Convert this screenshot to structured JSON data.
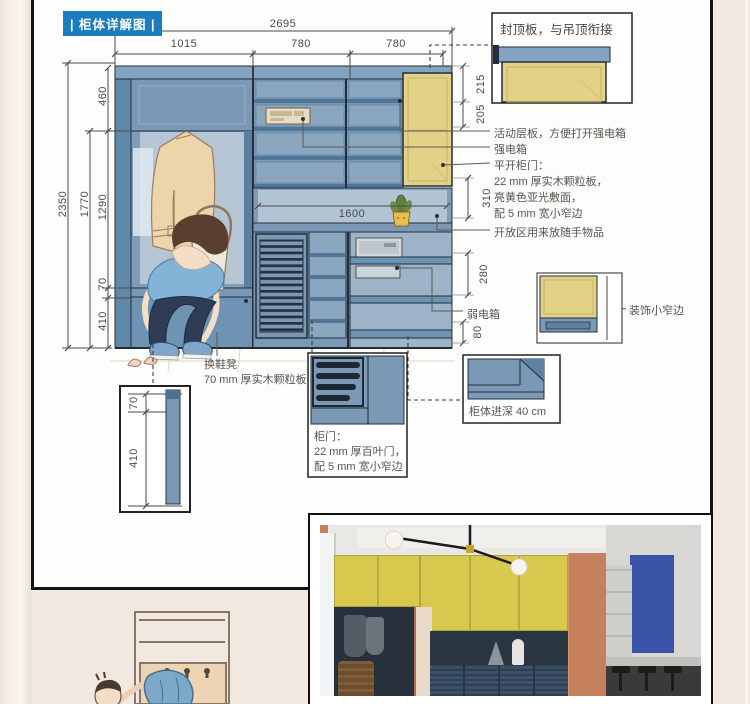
{
  "title": "| 柜体详解图 |",
  "dims": {
    "total_width": "2695",
    "col1": "1015",
    "col2": "780",
    "col3": "780",
    "total_height": "2350",
    "top_cab": "460",
    "open_total": "1770",
    "open_h": "1290",
    "bench_top": "70",
    "bench_h": "410",
    "r215": "215",
    "r205": "205",
    "r310": "310",
    "r280": "280",
    "r80": "80",
    "shelf_width": "1600",
    "bench_d70": "70",
    "bench_d410": "410"
  },
  "notes": {
    "cap_board": "封顶板，与吊顶衔接",
    "movable_shelf": "活动层板，方便打开强电箱",
    "strong_box": "强电箱",
    "swing1": "平开柜门：",
    "swing2": "22 mm 厚实木颗粒板，",
    "swing3": "亮黄色亚光敷面，",
    "swing4": "配 5 mm 宽小窄边",
    "open_area": "开放区用来放随手物品",
    "weak_box": "弱电箱",
    "deco_edge": "装饰小窄边",
    "depth": "柜体进深 40 cm",
    "louver1": "柜门：",
    "louver2": "22 mm 厚百叶门，",
    "louver3": "配 5 mm 宽小窄边",
    "bench": "换鞋凳",
    "bench_board": "70 mm 厚实木颗粒板"
  },
  "colors": {
    "badge_blue": "#1b7cc0",
    "cabinet_blue": "#7b99b5",
    "door_yellow": "#e3d286",
    "photo_upper_yellow": "#d8c94e",
    "photo_lower_navy": "#3d5166",
    "wall_terracotta": "#c5815d",
    "page_bg": "#f1e9e0"
  }
}
